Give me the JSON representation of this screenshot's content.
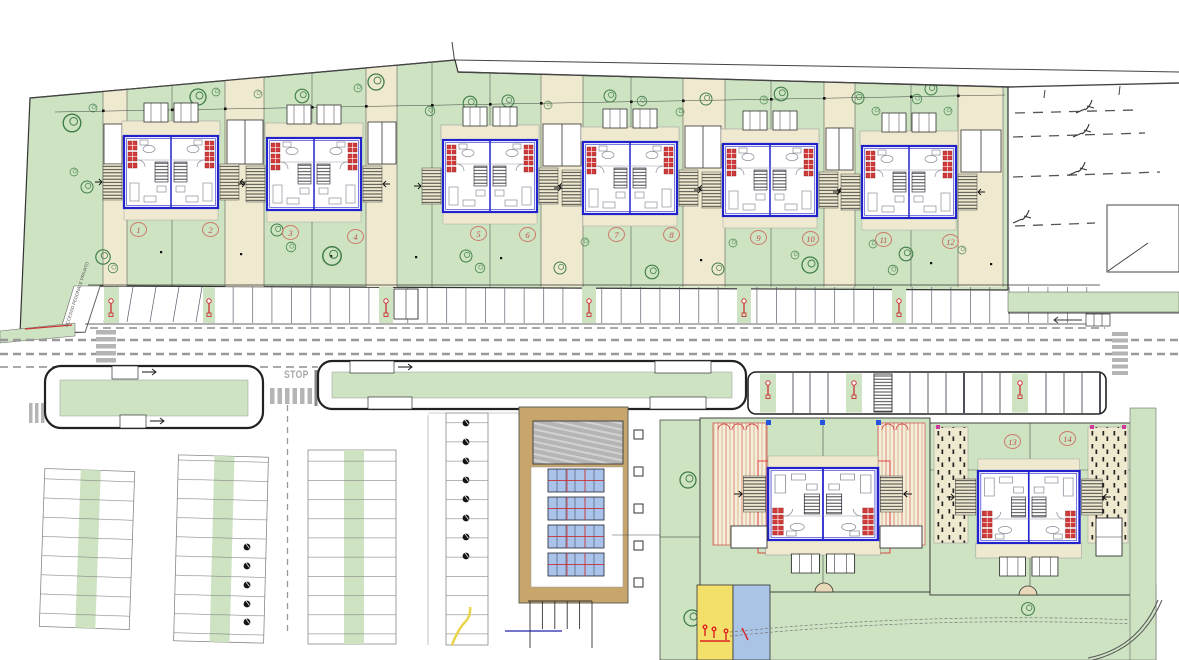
{
  "plan": {
    "type": "residential site plan (top view)",
    "stop_marking": "STOP",
    "access_path_label": "ACCESSO PEDONALE PRIVATO",
    "lots": [
      {
        "label": "1"
      },
      {
        "label": "2"
      },
      {
        "label": "3"
      },
      {
        "label": "4"
      },
      {
        "label": "5"
      },
      {
        "label": "6"
      },
      {
        "label": "7"
      },
      {
        "label": "8"
      },
      {
        "label": "9"
      },
      {
        "label": "10"
      },
      {
        "label": "11"
      },
      {
        "label": "12"
      },
      {
        "label": "13"
      },
      {
        "label": "14"
      }
    ],
    "colors": {
      "lawn": "#cde3c2",
      "paving": "#efe9cf",
      "deck_tan": "#c8a66b",
      "building_blue": "#2222cc",
      "accent_red": "#cf3a3a",
      "pool_blue": "#a9c3ea",
      "road_marking": "#b5b5b5",
      "playground_yellow": "#f2e06a",
      "playground_blue": "#a9c4e4"
    }
  }
}
